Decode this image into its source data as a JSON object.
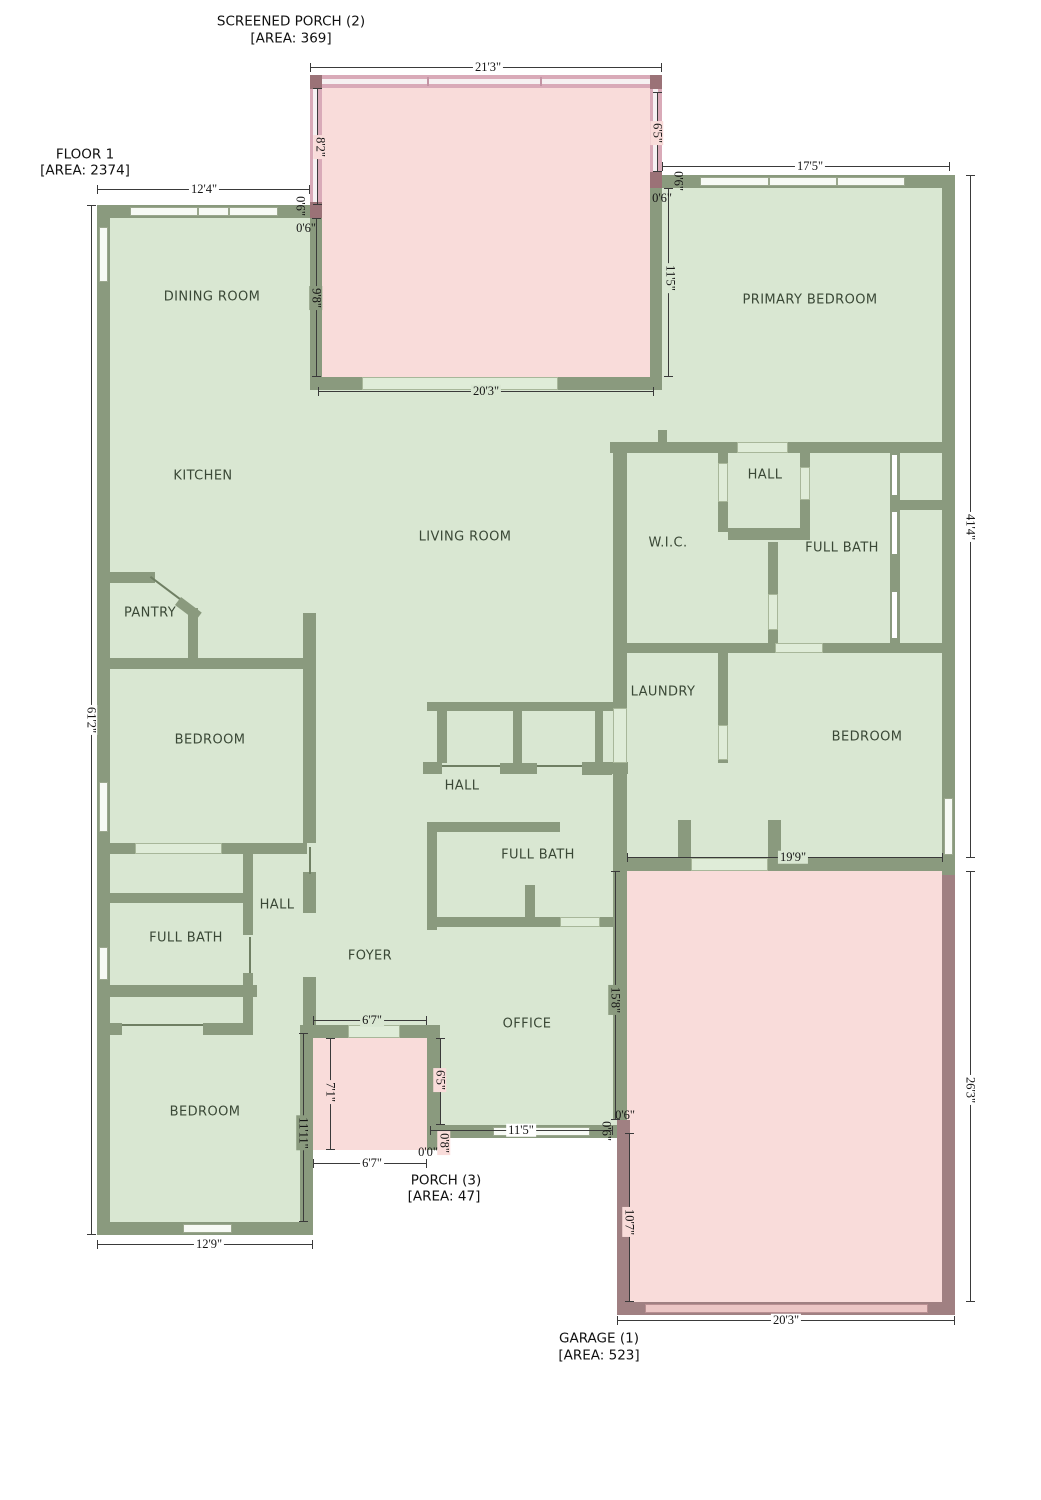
{
  "titles": {
    "screened_porch": {
      "line1": "SCREENED PORCH (2)",
      "line2": "[AREA: 369]"
    },
    "floor": {
      "line1": "FLOOR 1",
      "line2": "[AREA: 2374]"
    },
    "porch": {
      "line1": "PORCH (3)",
      "line2": "[AREA: 47]"
    },
    "garage": {
      "line1": "GARAGE (1)",
      "line2": "[AREA: 523]"
    }
  },
  "rooms": [
    {
      "name": "DINING ROOM"
    },
    {
      "name": "PRIMARY BEDROOM"
    },
    {
      "name": "KITCHEN"
    },
    {
      "name": "LIVING ROOM"
    },
    {
      "name": "HALL"
    },
    {
      "name": "W.I.C."
    },
    {
      "name": "FULL BATH"
    },
    {
      "name": "PANTRY"
    },
    {
      "name": "LAUNDRY"
    },
    {
      "name": "BEDROOM"
    },
    {
      "name": "BEDROOM"
    },
    {
      "name": "HALL"
    },
    {
      "name": "HALL"
    },
    {
      "name": "FULL BATH"
    },
    {
      "name": "FULL BATH"
    },
    {
      "name": "FOYER"
    },
    {
      "name": "OFFICE"
    },
    {
      "name": "BEDROOM"
    }
  ],
  "dimensions": [
    {
      "text": "21'3\""
    },
    {
      "text": "8'2\""
    },
    {
      "text": "6'5\""
    },
    {
      "text": "0'6\""
    },
    {
      "text": "0'6\""
    },
    {
      "text": "9'8\""
    },
    {
      "text": "0'6\""
    },
    {
      "text": "0'6\""
    },
    {
      "text": "11'5\""
    },
    {
      "text": "20'3\""
    },
    {
      "text": "12'4\""
    },
    {
      "text": "17'5\""
    },
    {
      "text": "61'2\""
    },
    {
      "text": "41'4\""
    },
    {
      "text": "26'3\""
    },
    {
      "text": "19'9\""
    },
    {
      "text": "15'8\""
    },
    {
      "text": "0'6\""
    },
    {
      "text": "0'6\""
    },
    {
      "text": "10'7\""
    },
    {
      "text": "20'3\""
    },
    {
      "text": "12'9\""
    },
    {
      "text": "11'11\""
    },
    {
      "text": "6'7\""
    },
    {
      "text": "7'1\""
    },
    {
      "text": "6'5\""
    },
    {
      "text": "0'8\""
    },
    {
      "text": "0'0\""
    },
    {
      "text": "6'7\""
    },
    {
      "text": "11'5\""
    }
  ],
  "colors": {
    "floor_green": "#d9e7d2",
    "wall_green": "#8a9a7e",
    "room_pink": "#f9dcda",
    "garage_wall": "#a08082",
    "screen_wall": "#d9aab8",
    "corner_block": "#9b7277",
    "dimension_ink": "#3a3a3a",
    "room_label_ink": "#3a4836"
  }
}
